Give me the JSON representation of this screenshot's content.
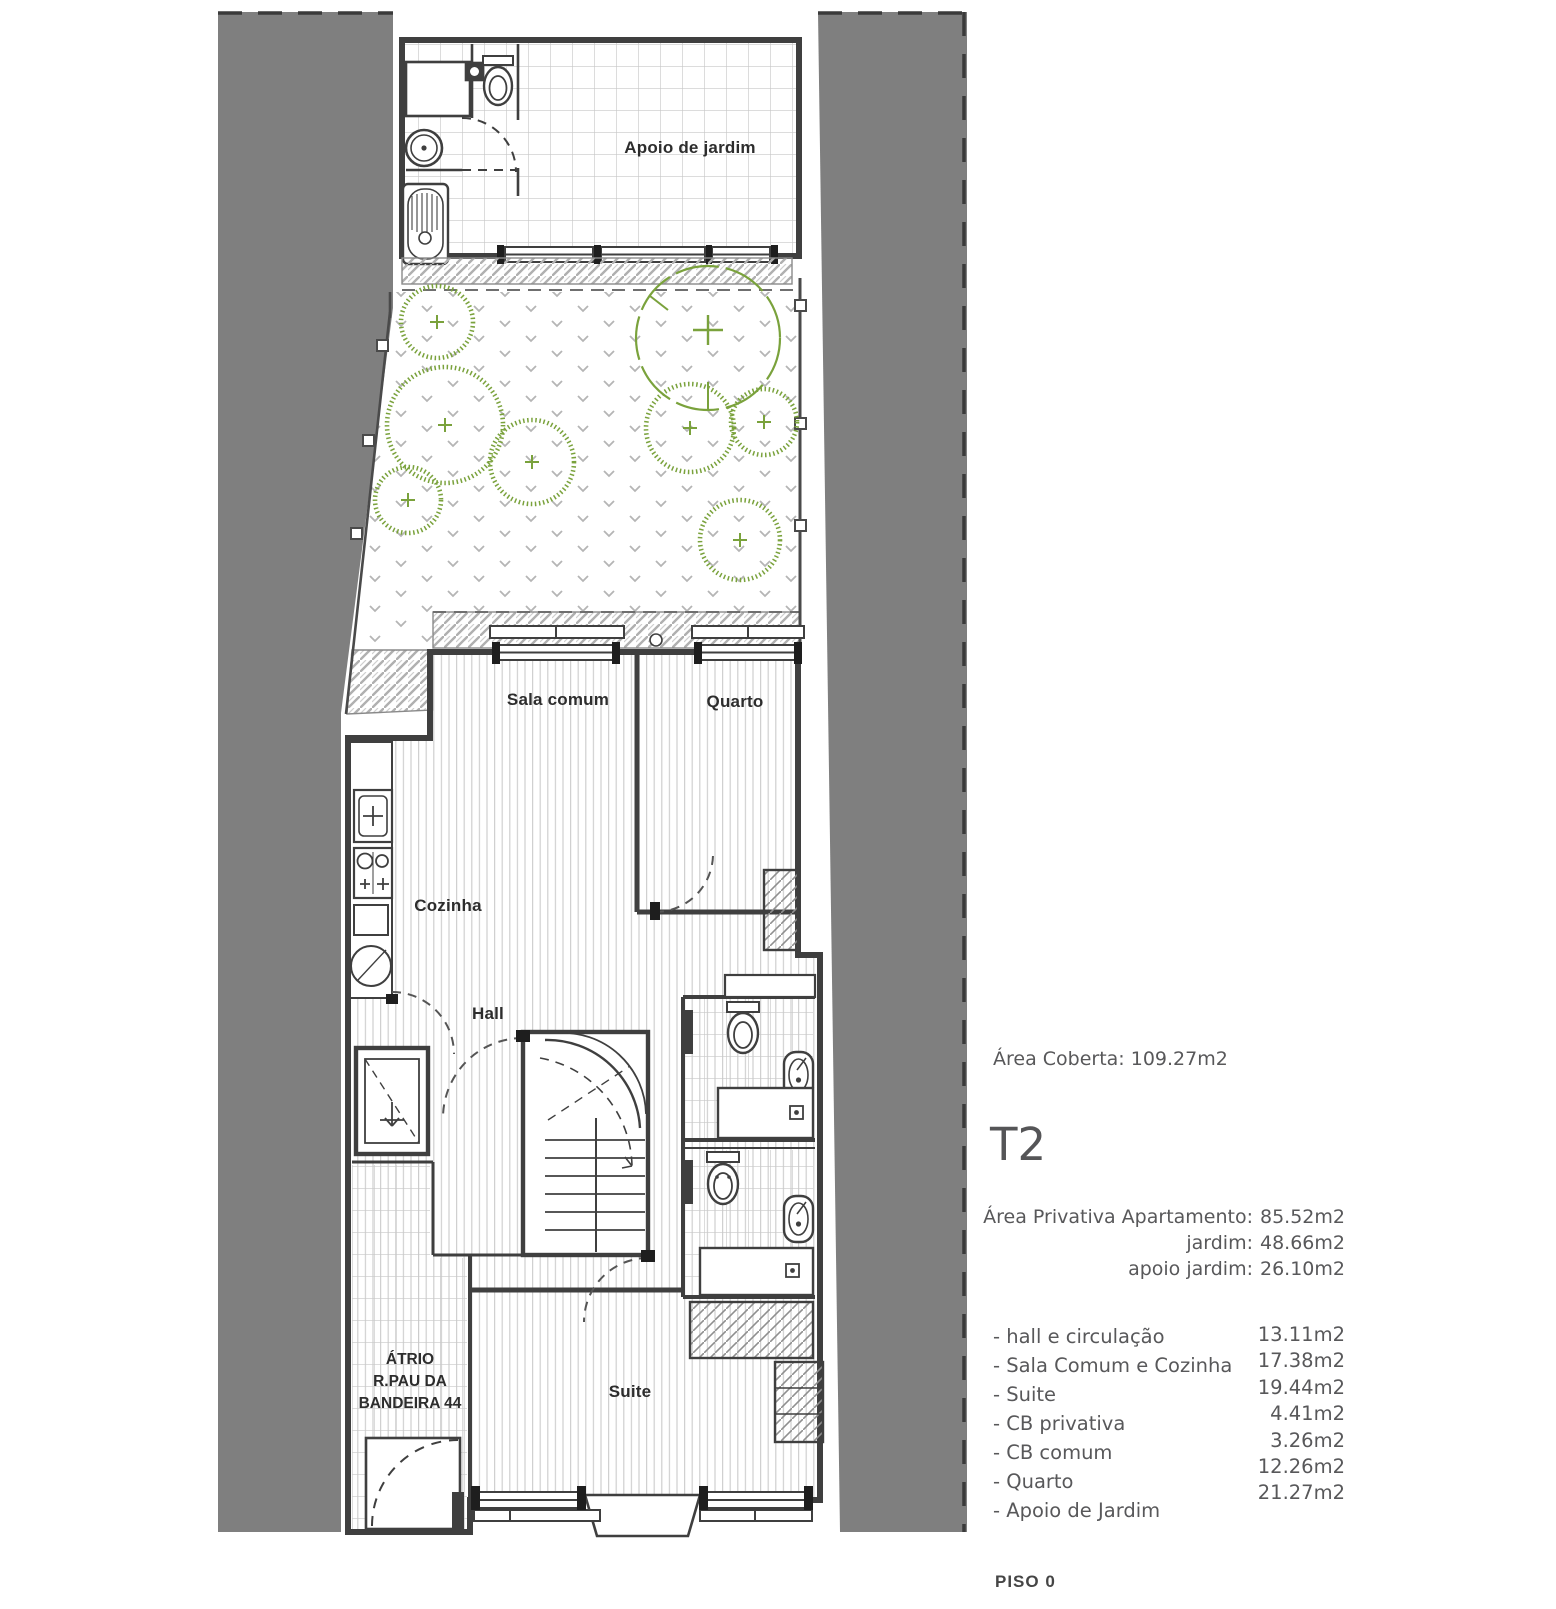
{
  "plan": {
    "rooms": {
      "apoio": "Apoio de jardim",
      "sala": "Sala comum",
      "quarto": "Quarto",
      "cozinha": "Cozinha",
      "hall": "Hall",
      "suite": "Suite",
      "atrio": [
        "ÁTRIO",
        "R.PAU DA",
        "BANDEIRA 44"
      ]
    }
  },
  "info": {
    "area_coberta": "Área Coberta: 109.27m2",
    "unit_type": "T2",
    "private_areas": [
      {
        "label": "Área Privativa Apartamento:",
        "value": "85.52m2"
      },
      {
        "label": "jardim:",
        "value": "48.66m2"
      },
      {
        "label": "apoio jardim:",
        "value": "26.10m2"
      }
    ],
    "room_areas": [
      {
        "label": "- hall e circulação",
        "value": "13.11m2"
      },
      {
        "label": "- Sala Comum e Cozinha",
        "value": "17.38m2"
      },
      {
        "label": "- Suite",
        "value": "19.44m2"
      },
      {
        "label": "- CB privativa",
        "value": "4.41m2"
      },
      {
        "label": "- CB comum",
        "value": "3.26m2"
      },
      {
        "label": "- Quarto",
        "value": "12.26m2"
      },
      {
        "label": "- Apoio de Jardim",
        "value": "21.27m2"
      }
    ],
    "floor_label": "PISO 0"
  },
  "colors": {
    "site_gray": "#7f7f7f",
    "wall_line": "#3f3f3f",
    "text_gray": "#58585a",
    "plant_green": "#7aa23c",
    "floor_stripe": "#cfcfcf",
    "tile_line": "#c8c8c8"
  }
}
